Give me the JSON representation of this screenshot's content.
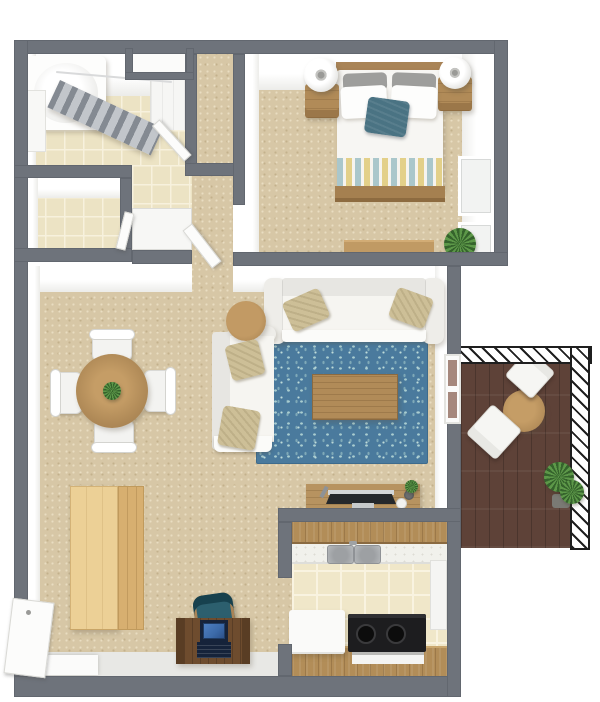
{
  "scene": {
    "title": "3D apartment floor plan, top-down view"
  },
  "palette": {
    "wall": "#6e737b",
    "wall_face": "#ffffff",
    "carpet": "#d7c7a6",
    "tile": "#ece3c4",
    "kitchen_tile": "#f0e7c9",
    "rug_blue": "#4a7a9d",
    "rug_fleck": "#a9cdd0",
    "wood": "#b18b58",
    "wood_light": "#ecd096",
    "wood_dark": "#6e4c2e",
    "deck": "#5e4238",
    "sofa": "#f6f5f1",
    "cushion_tan": "#cdbf97",
    "pillow_teal": "#4a7383",
    "stripe_yellow": "#e3d089",
    "stripe_teal": "#aac7cb",
    "stove_black": "#1d1d1f",
    "plant_green": "#5d9849",
    "laptop_blue": "#3b69a8",
    "chair_teal": "#2c5f6e"
  },
  "rooms": {
    "bathroom": {
      "label": "Bathroom",
      "items": [
        "bathtub",
        "shower-curtain",
        "curtain-rod",
        "wall-shelves",
        "vanity-cabinet",
        "bathroom-door",
        "tile-floor"
      ]
    },
    "storage": {
      "label": "Storage closet",
      "items": [
        "tile-floor",
        "storage-door"
      ]
    },
    "hallway": {
      "label": "Hallway",
      "items": [
        "linen-closet-niche",
        "closet-nook",
        "sliding-closet-doors",
        "bedroom-door",
        "carpet"
      ]
    },
    "bedroom": {
      "label": "Bedroom",
      "items": [
        "double-bed",
        "headboard",
        "gray-pillows",
        "white-pillows",
        "teal-accent-pillow",
        "striped-throw-blanket",
        "wood-footboard",
        "nightstand-left",
        "nightstand-right",
        "table-lamp-left",
        "table-lamp-right",
        "low-dresser",
        "potted-plant",
        "window-upper",
        "window-lower"
      ]
    },
    "living": {
      "label": "Living room",
      "items": [
        "sectional-sofa-long",
        "sectional-sofa-side",
        "tan-throw-pillows",
        "round-side-table",
        "blue-floral-area-rug",
        "wood-coffee-table",
        "tv-console",
        "flat-screen-tv",
        "remote-control",
        "cups",
        "mini-plant"
      ]
    },
    "dining": {
      "label": "Dining area",
      "items": [
        "round-dining-table",
        "dining-chair-top",
        "dining-chair-bottom",
        "dining-chair-left",
        "dining-chair-right",
        "centerpiece-plant"
      ]
    },
    "office": {
      "label": "Work corner",
      "items": [
        "wardrobe-cabinet",
        "writing-desk",
        "open-laptop",
        "teal-desk-chair"
      ]
    },
    "kitchen": {
      "label": "Kitchen",
      "items": [
        "upper-cabinets",
        "countertop",
        "double-sink",
        "faucet",
        "cooktop",
        "oven-front",
        "dishwasher",
        "base-cabinets",
        "tall-white-cabinet",
        "tile-floor"
      ]
    },
    "balcony": {
      "label": "Balcony",
      "items": [
        "railing",
        "wood-deck",
        "bistro-table",
        "balcony-chair-upper",
        "balcony-chair-lower",
        "potted-plant",
        "balcony-door"
      ]
    },
    "entry": {
      "label": "Entry",
      "items": [
        "front-door",
        "door-mat",
        "threshold-floor"
      ]
    }
  }
}
